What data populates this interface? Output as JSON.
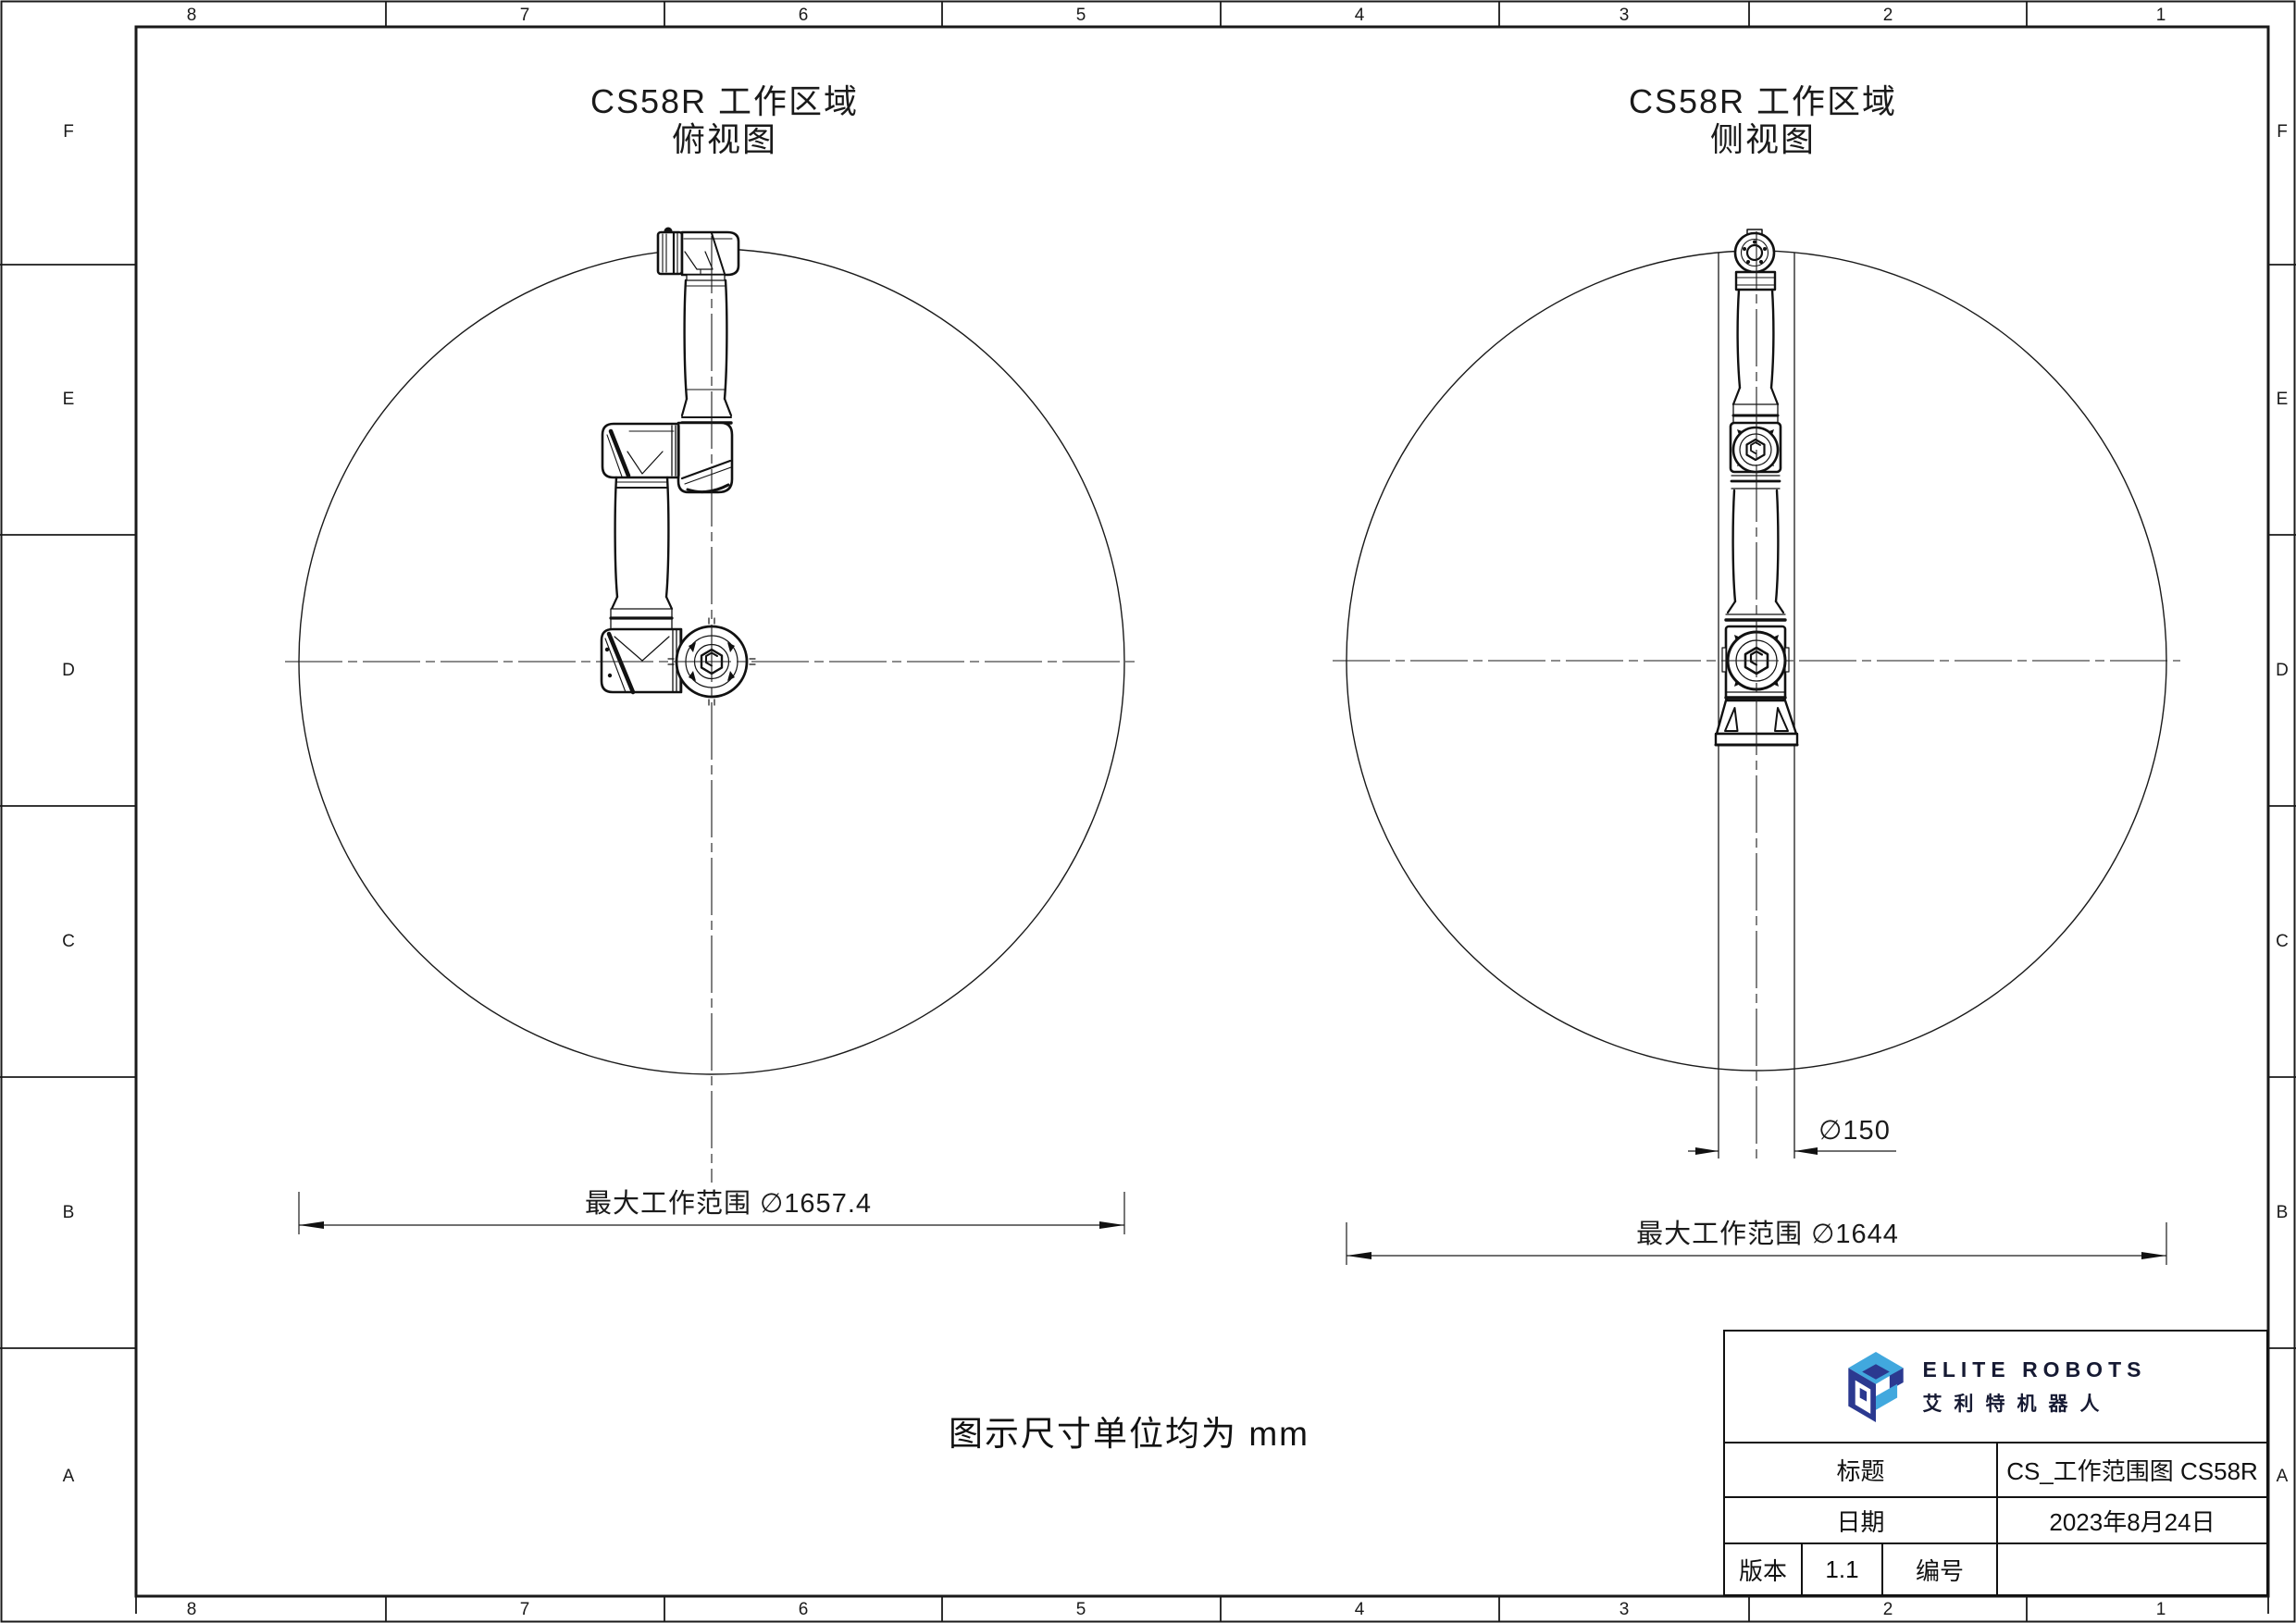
{
  "sheet": {
    "zone_columns": [
      "8",
      "7",
      "6",
      "5",
      "4",
      "3",
      "2",
      "1"
    ],
    "zone_rows": [
      "F",
      "E",
      "D",
      "C",
      "B",
      "A"
    ]
  },
  "views": {
    "top": {
      "title": "CS58R 工作区域",
      "subtitle": "俯视图",
      "dim_max": "最大工作范围 ∅1657.4"
    },
    "side": {
      "title": "CS58R 工作区域",
      "subtitle": "侧视图",
      "dim_base": "∅150",
      "dim_max": "最大工作范围 ∅1644"
    }
  },
  "note": "图示尺寸单位均为 mm",
  "title_block": {
    "brand_en": "ELITE ROBOTS",
    "brand_cn": "艾利特机器人",
    "title_label": "标题",
    "title_value": "CS_工作范围图 CS58R",
    "date_label": "日期",
    "date_value": "2023年8月24日",
    "version_label": "版本",
    "version_value": "1.1",
    "number_label": "编号",
    "number_value": ""
  },
  "colors": {
    "ink": "#1a1a1a",
    "brand_navy": "#2b3990",
    "brand_blue": "#41a8de"
  }
}
